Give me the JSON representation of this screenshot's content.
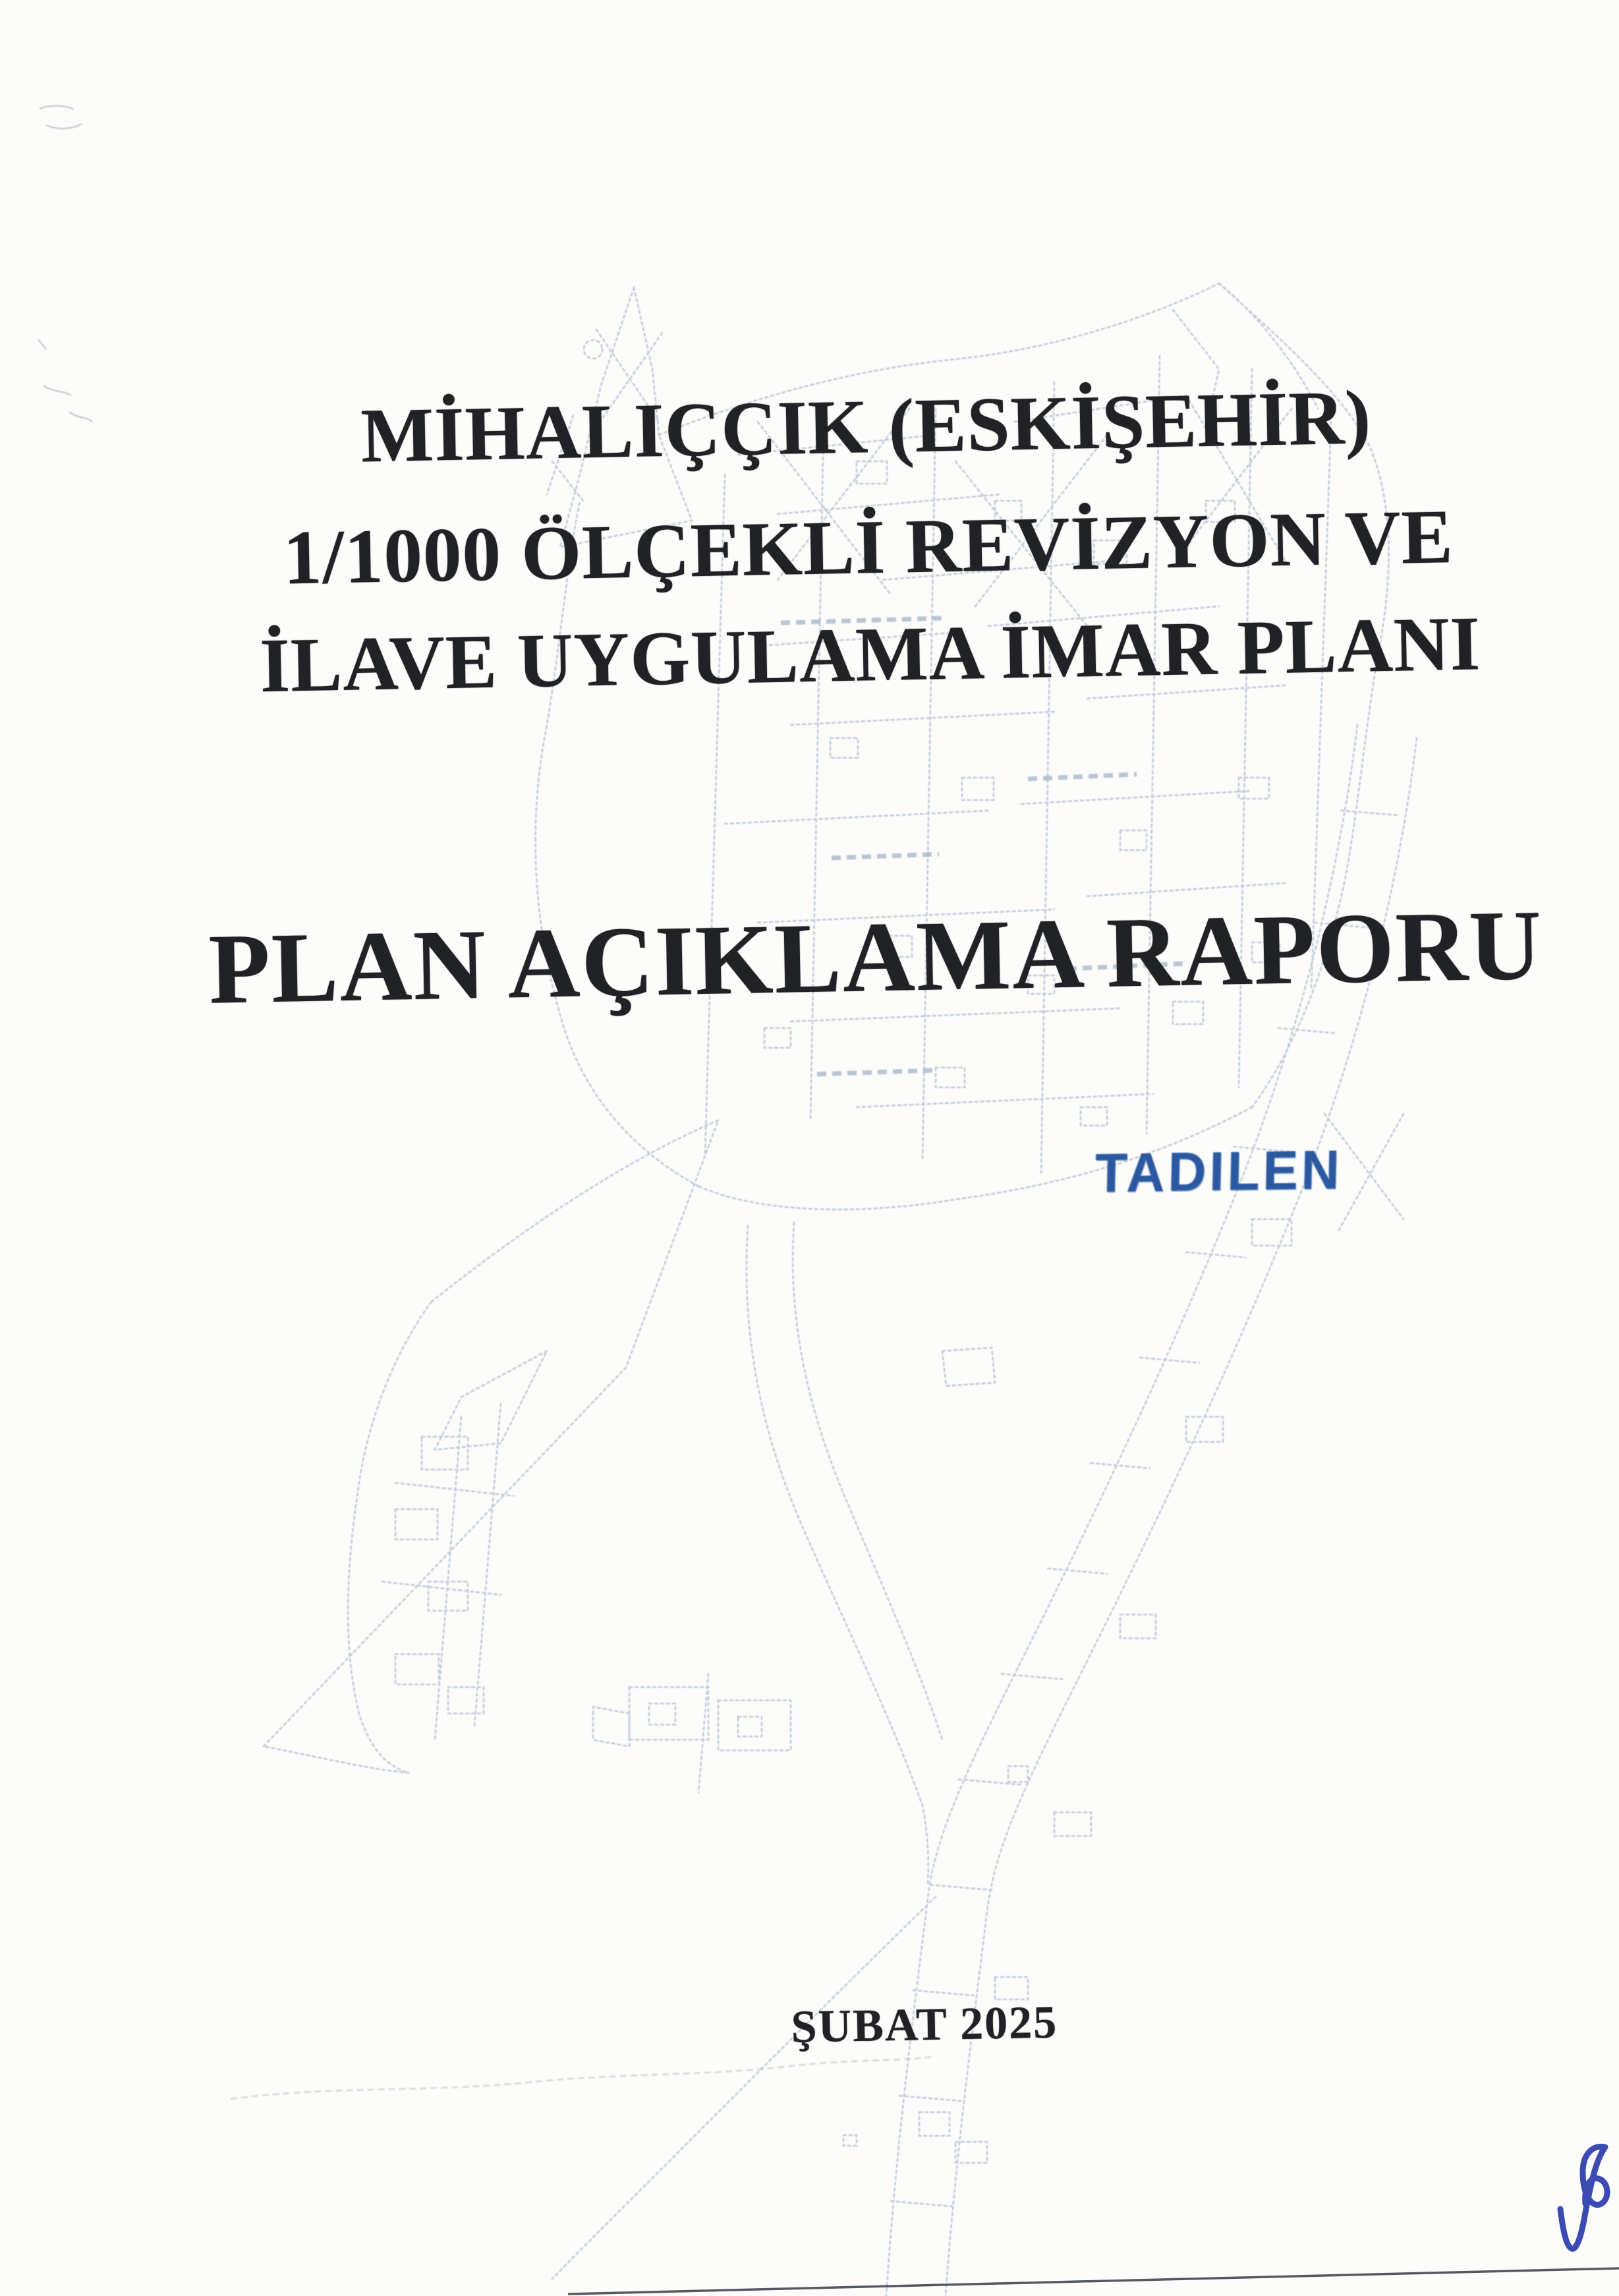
{
  "document": {
    "title_lines": [
      "MİHALIÇÇIK (ESKİŞEHİR)",
      "1/1000 ÖLÇEKLİ REVİZYON VE",
      "İLAVE UYGULAMA İMAR PLANI"
    ],
    "report_title": "PLAN AÇIKLAMA RAPORU",
    "date": "ŞUBAT 2025"
  },
  "stamp": {
    "text": "TADILEN",
    "ink_color": "#1b4d9b"
  },
  "signature": {
    "ink_color": "#2b3cad"
  },
  "watermark": {
    "content": "faint city development plan line map",
    "line_color": "#a9b7ca"
  },
  "colors": {
    "paper": "#fcfcfb",
    "text_black": "#212226",
    "page_edge_line": "#3c4248"
  }
}
